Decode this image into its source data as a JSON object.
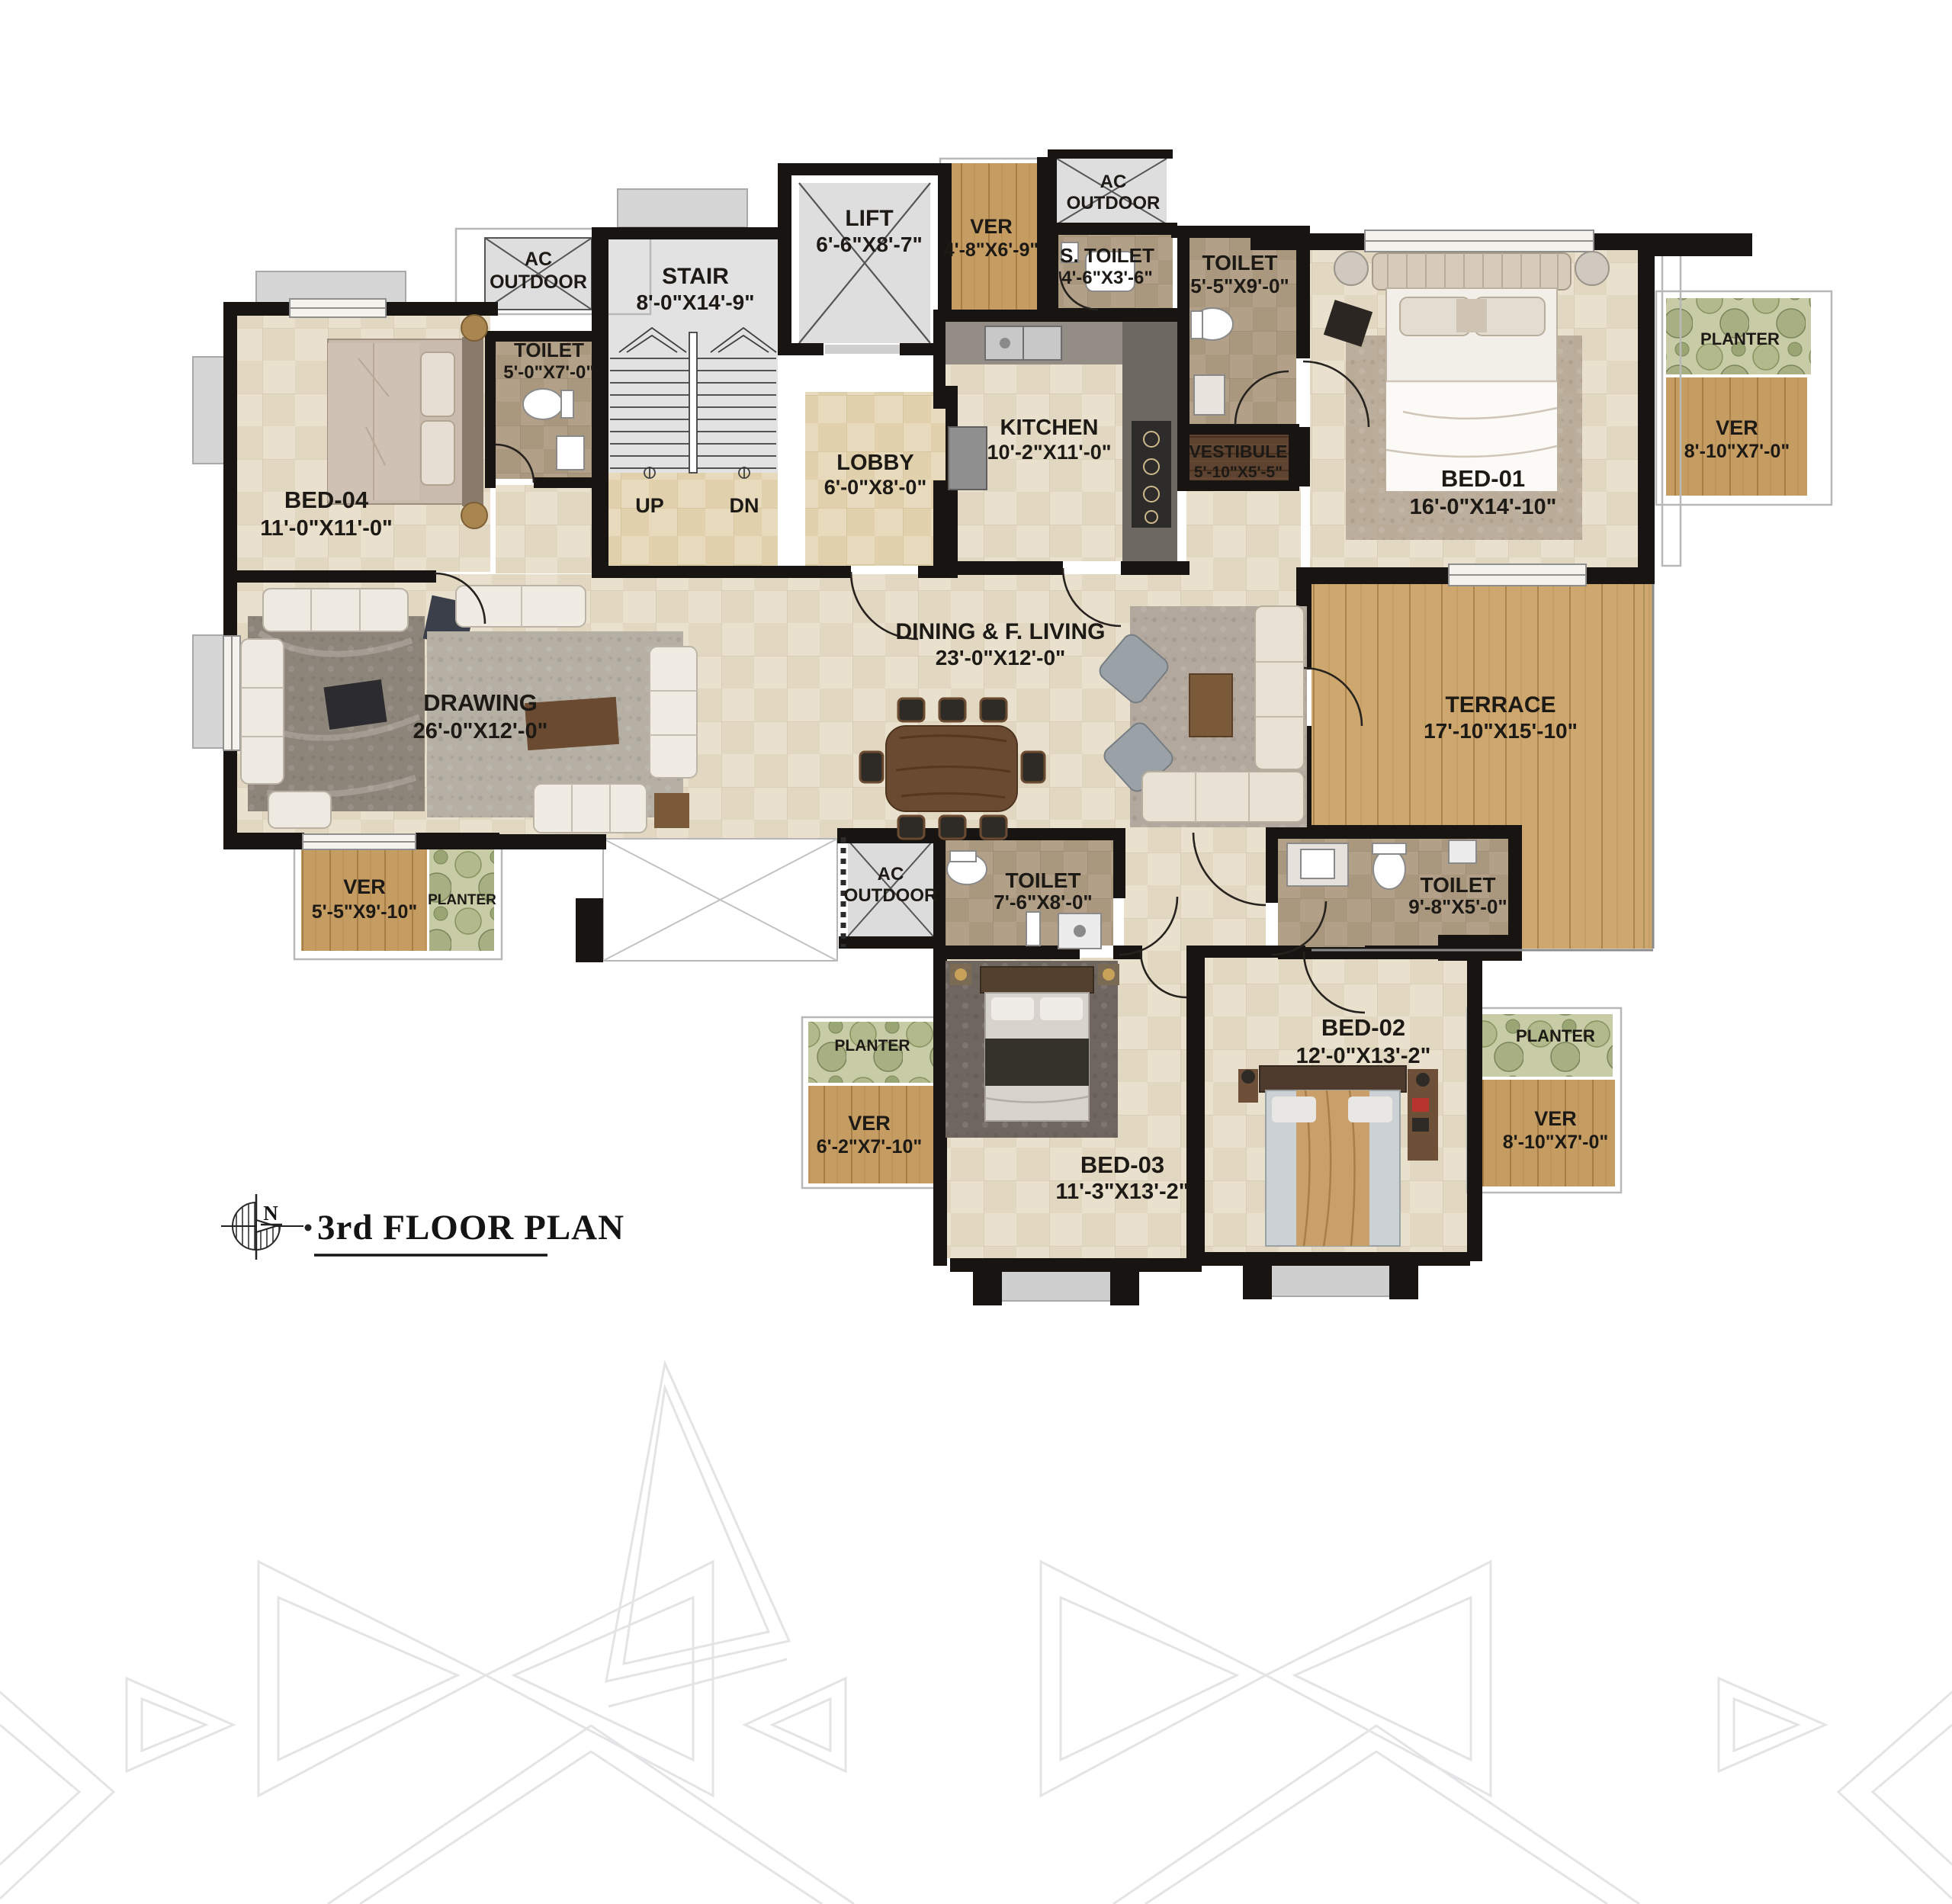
{
  "title": {
    "text": "3rd FLOOR PLAN",
    "north": "N"
  },
  "stairLabels": {
    "up": "UP",
    "dn": "DN"
  },
  "colors": {
    "wall": "#171411",
    "tile_floor": "#e9e0cd",
    "toilet_tile": "#b2a089",
    "wood_floor": "#c79e62",
    "terrace_wood": "#cda76d",
    "vestibule_wood": "#5e4331",
    "planter_green": "#c7cba6",
    "service_gray": "#dedede",
    "lobby_tile": "#e8dabd"
  },
  "rooms": {
    "acOutdoorTL": {
      "l1": "AC",
      "l2": "OUTDOOR"
    },
    "stair": {
      "name": "STAIR",
      "dims": "8'-0\"X14'-9\""
    },
    "lift": {
      "name": "LIFT",
      "dims": "6'-6\"X8'-7\""
    },
    "verTop": {
      "name": "VER",
      "dims": "4'-8\"X6'-9\""
    },
    "acOutdoorTop": {
      "l1": "AC",
      "l2": "OUTDOOR"
    },
    "sToilet": {
      "name": "S. TOILET",
      "dims": "4'-6\"X3'-6\""
    },
    "toiletTop": {
      "name": "TOILET",
      "dims": "5'-5\"X9'-0\""
    },
    "bed01": {
      "name": "BED-01",
      "dims": "16'-0\"X14'-10\""
    },
    "planterTR": {
      "name": "PLANTER"
    },
    "verTR": {
      "name": "VER",
      "dims": "8'-10\"X7'-0\""
    },
    "toiletBed04": {
      "name": "TOILET",
      "dims": "5'-0\"X7'-0\""
    },
    "bed04": {
      "name": "BED-04",
      "dims": "11'-0\"X11'-0\""
    },
    "lobby": {
      "name": "LOBBY",
      "dims": "6'-0\"X8'-0\""
    },
    "kitchen": {
      "name": "KITCHEN",
      "dims": "10'-2\"X11'-0\""
    },
    "vestibule": {
      "name": "VESTIBULE",
      "dims": "5'-10\"X5'-5\""
    },
    "drawing": {
      "name": "DRAWING",
      "dims": "26'-0\"X12'-0\""
    },
    "dining": {
      "name": "DINING & F. LIVING",
      "dims": "23'-0\"X12'-0\""
    },
    "terrace": {
      "name": "TERRACE",
      "dims": "17'-10\"X15'-10\""
    },
    "verBL": {
      "name": "VER",
      "dims": "5'-5\"X9'-10\""
    },
    "planterBL": {
      "name": "PLANTER"
    },
    "acOutdoorB": {
      "l1": "AC",
      "l2": "OUTDOOR"
    },
    "toiletB1": {
      "name": "TOILET",
      "dims": "7'-6\"X8'-0\""
    },
    "toiletB2": {
      "name": "TOILET",
      "dims": "9'-8\"X5'-0\""
    },
    "bed02": {
      "name": "BED-02",
      "dims": "12'-0\"X13'-2\""
    },
    "planterBC": {
      "name": "PLANTER"
    },
    "verBC": {
      "name": "VER",
      "dims": "6'-2\"X7'-10\""
    },
    "bed03": {
      "name": "BED-03",
      "dims": "11'-3\"X13'-2\""
    },
    "planterBR": {
      "name": "PLANTER"
    },
    "verBR": {
      "name": "VER",
      "dims": "8'-10\"X7'-0\""
    }
  }
}
